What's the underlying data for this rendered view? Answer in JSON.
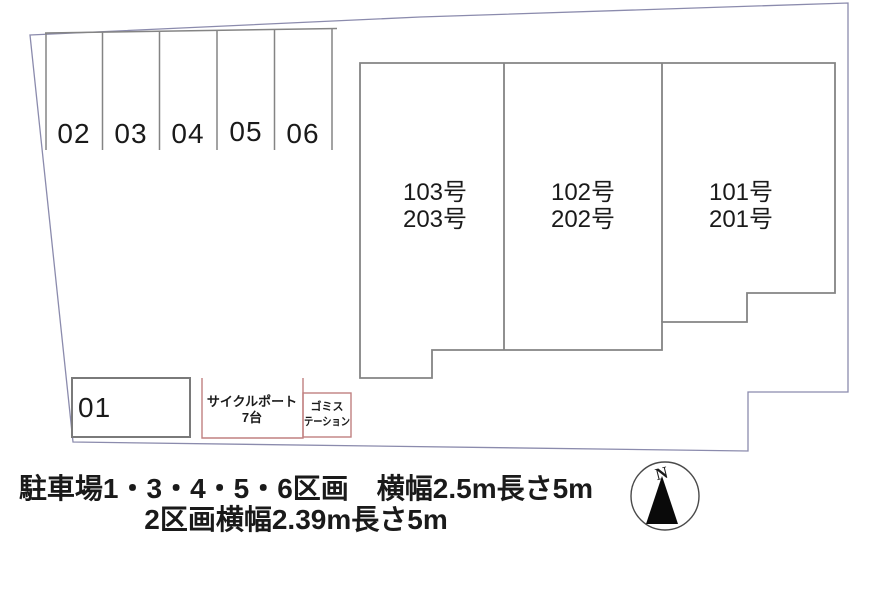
{
  "site_plan": {
    "stall_row_labels": [
      "02",
      "03",
      "04",
      "05",
      "06"
    ],
    "stall_01_label": "01",
    "building_units": [
      {
        "upper": "103号",
        "lower": "203号"
      },
      {
        "upper": "102号",
        "lower": "202号"
      },
      {
        "upper": "101号",
        "lower": "201号"
      }
    ],
    "cycle_port": {
      "name": "サイクルポート",
      "capacity": "7台"
    },
    "garbage_station": {
      "line1": "ゴミス",
      "line2": "テーション"
    },
    "compass": {
      "north_label": "N"
    },
    "caption": {
      "line1": "駐車場1・3・4・5・6区画　横幅2.5m長さ5m",
      "line2": "2区画横幅2.39m長さ5m"
    },
    "colors": {
      "drawing_line": "#848484",
      "boundary_line": "#8b8bad",
      "accent_line": "#c08080",
      "text": "#1a1a1a"
    }
  }
}
